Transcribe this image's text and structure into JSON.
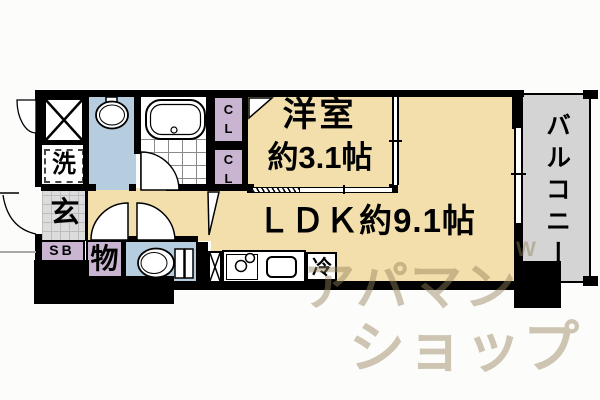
{
  "floor_plan": {
    "western_room": {
      "name": "洋室",
      "size": "約3.1帖"
    },
    "ldk": {
      "label": "ＬＤＫ約9.1帖"
    },
    "balcony": {
      "label": "バルコニー"
    },
    "entrance": {
      "label": "玄"
    },
    "storage": {
      "label": "物"
    },
    "shoe_box": {
      "label": "SB"
    },
    "washer": {
      "label": "洗"
    },
    "closet_upper": {
      "char1": "C",
      "char2": "L"
    },
    "closet_lower": {
      "char1": "C",
      "char2": "L"
    },
    "refrigerator": {
      "label": "冷"
    },
    "colors": {
      "room_floor": "#F2DFAC",
      "wet_area": "#B6CDDF",
      "storage_fill": "#C9B4D1",
      "balcony_floor": "#D4D4D4",
      "entrance_floor": "#DCDCDC",
      "wall": "#000000",
      "watermark": "#C8B183"
    }
  },
  "watermark": {
    "logo_mark": "W",
    "line1": "アパマン",
    "line2": "ショップ"
  }
}
